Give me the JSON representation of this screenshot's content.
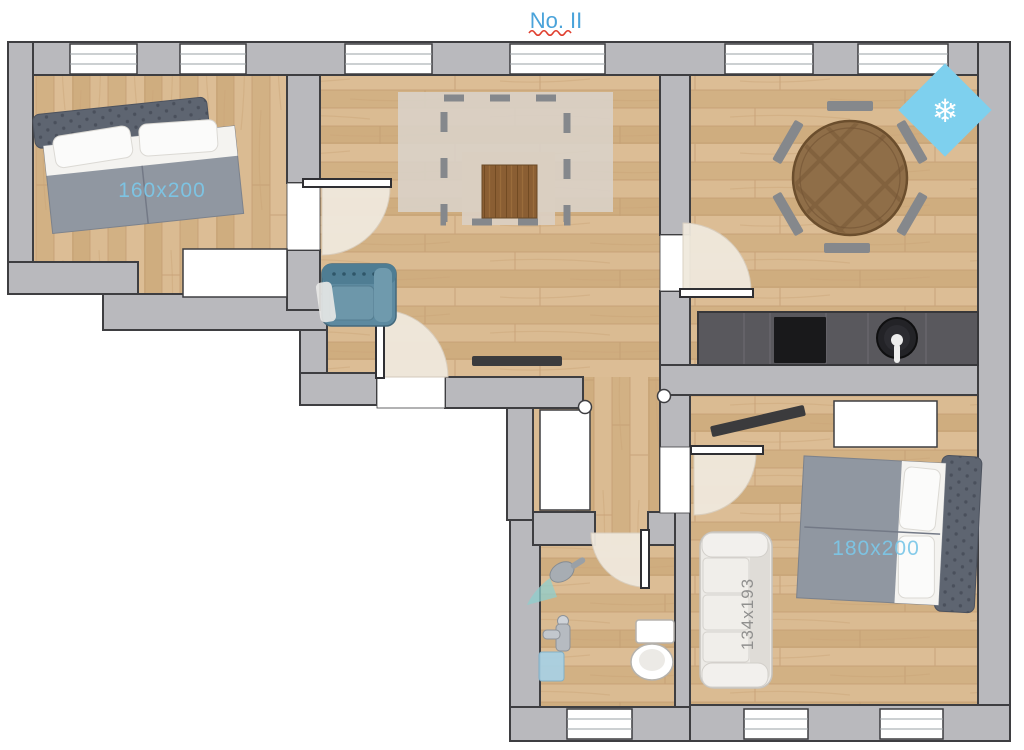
{
  "title": {
    "text": "No. II"
  },
  "rooms": {
    "bedroom_small": {
      "bed_size": "160x200"
    },
    "bedroom_large": {
      "bed_size": "180x200",
      "couch_size": "134x193"
    }
  },
  "icons": {
    "air_conditioner_snowflake": "❄"
  },
  "colors": {
    "title_blue": "#4aa3da",
    "spellcheck_red": "#e04030",
    "size_label_blue": "#7cc7e8",
    "couch_label_gray": "#90908f",
    "wall_gray": "#b9b9bd",
    "wall_outline": "#3e3e41",
    "floor_wood": "#d7b68c",
    "ac_blue": "#7ed0ee",
    "door_swing_beige": "#f0e9dd",
    "counter_gray": "#59585d"
  }
}
